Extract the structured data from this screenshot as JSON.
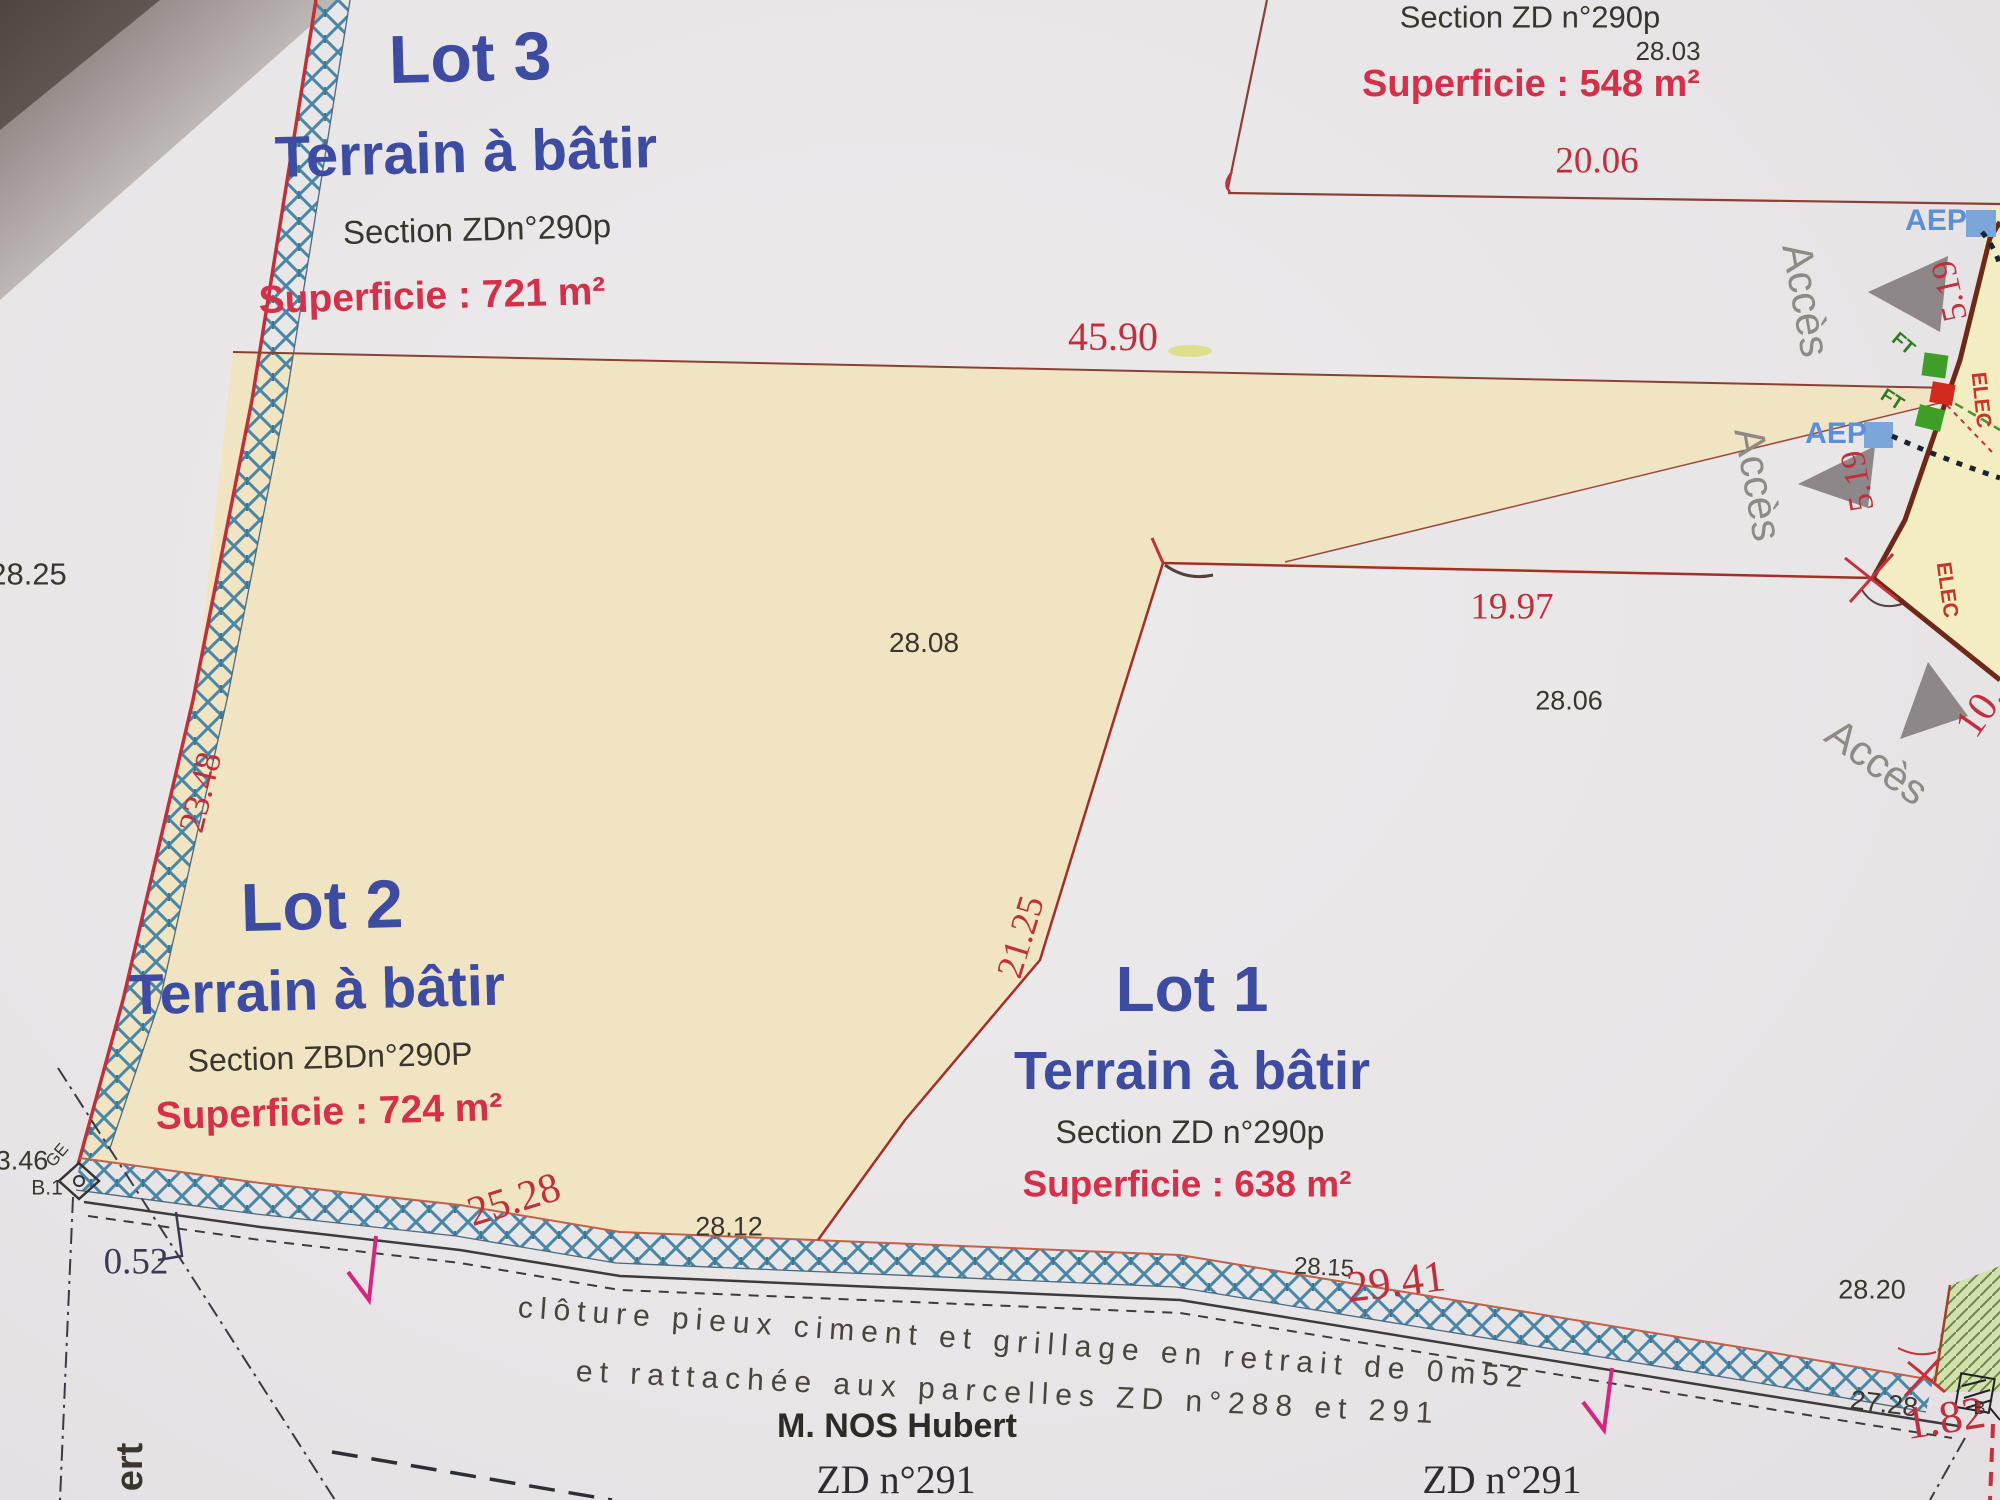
{
  "lots": {
    "lot3": {
      "title": "Lot 3",
      "type": "Terrain à bâtir",
      "section": "Section ZDn°290p",
      "area": "Superficie : 721 m²"
    },
    "lot2": {
      "title": "Lot 2",
      "type": "Terrain à bâtir",
      "section": "Section ZBDn°290P",
      "area": "Superficie : 724 m²"
    },
    "lot1": {
      "title": "Lot 1",
      "type": "Terrain à bâtir",
      "section": "Section ZD n°290p",
      "area": "Superficie : 638 m²"
    },
    "parcel548": {
      "section": "Section ZD n°290p",
      "area": "Superficie : 548 m²"
    }
  },
  "dims": {
    "d2803": "28.03",
    "d2006": "20.06",
    "d4590": "45.90",
    "d2825": "28.25",
    "d2348": "23.48",
    "d2808": "28.08",
    "d1997": "19.97",
    "d2806": "28.06",
    "d2125": "21.25",
    "d2528": "25.28",
    "d2812": "28.12",
    "d2815": "28.15",
    "d2941": "29.41",
    "d2820": "28.20",
    "d2728": "27.28",
    "d182": "1.82",
    "d052": "0.52",
    "d346": "3.46",
    "d519a": "5.19",
    "d519b": "5.19",
    "d10": "10.",
    "b1": "B.1",
    "ge": "GE",
    "bdot": "B."
  },
  "labels": {
    "acces1": "Accès",
    "acces2": "Accès",
    "acces3": "Accès",
    "aep1": "AEP",
    "aep2": "AEP",
    "ft1": "FT",
    "ft2": "FT",
    "elec1": "ELEC",
    "elec2": "ELEC"
  },
  "notes": {
    "fence_line1": "clôture pieux ciment et grillage en retrait de 0m52",
    "fence_line2": "et rattachée aux parcelles ZD n°288 et 291",
    "owner": "M. NOS Hubert",
    "parcel_bottom_left": "ZD n°291",
    "parcel_bottom_right": "ZD n°291",
    "street_partial": "ert"
  },
  "colors": {
    "paper": "#e9e6e8",
    "beige": "#f1e4c3",
    "pale_yellow": "#f4edc2",
    "fence_blue": "#4a86a6",
    "boundary_red": "#8a4034",
    "road_red": "#6e2818",
    "dim_red": "#bf2f3c",
    "lot_blue": "#3d4ba0",
    "superficie_red": "#d5304a",
    "green_area": "#d2e2ae",
    "aep_blue": "#5c8fd6",
    "magenta": "#d4267e",
    "gray_triangle": "#8e8789"
  }
}
